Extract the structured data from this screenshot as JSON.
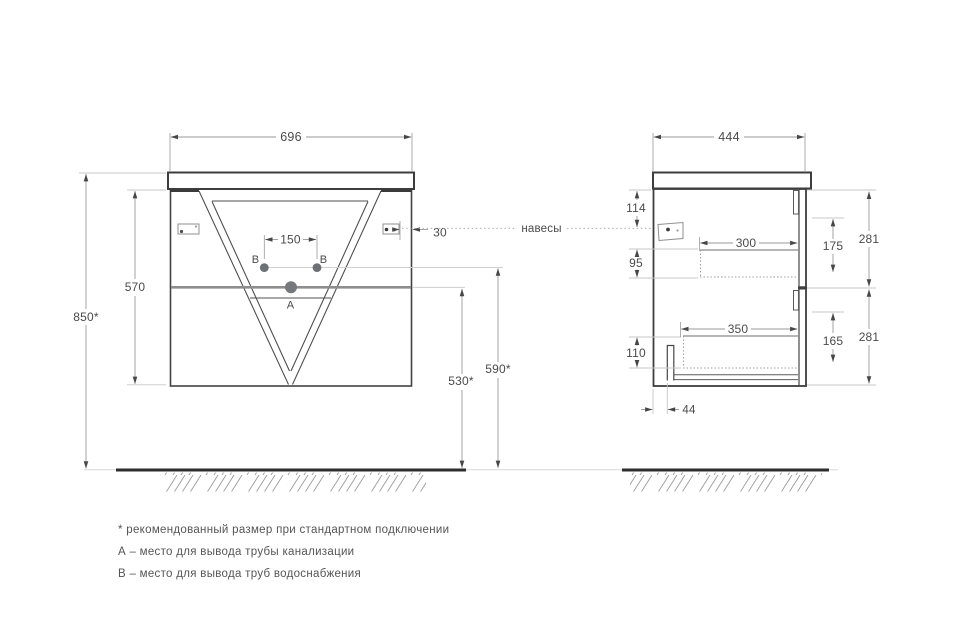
{
  "front_view": {
    "width": "696",
    "cabinet_height": "570",
    "mount_height": "850*",
    "drain_outlet_height": "530*",
    "water_outlet_height": "590*",
    "water_outlets_spacing": "150",
    "bracket_side_offset": "30",
    "drain_point": "A",
    "water_point_left": "B",
    "water_point_right": "B"
  },
  "side_view": {
    "depth": "444",
    "bracket_top_offset": "114",
    "upper_drawer_clearance": "95",
    "lower_drawer_clearance": "110",
    "upper_drawer_depth": "300",
    "lower_drawer_depth": "350",
    "upper_drawer_inner_height": "175",
    "lower_drawer_inner_height": "165",
    "upper_section_height": "281",
    "lower_section_height": "281",
    "pipe_back_offset": "44"
  },
  "callout": {
    "hangers": "навесы"
  },
  "notes": {
    "asterisk": "* рекомендованный размер при стандартном подключении",
    "point_a": "А – место для вывода трубы канализации",
    "point_b": "B – место для вывода труб водоснабжения"
  },
  "colors": {
    "line": "#3d3d3d",
    "dim_line": "#9a9a9a",
    "divider_gray": "#8d8d8d"
  }
}
